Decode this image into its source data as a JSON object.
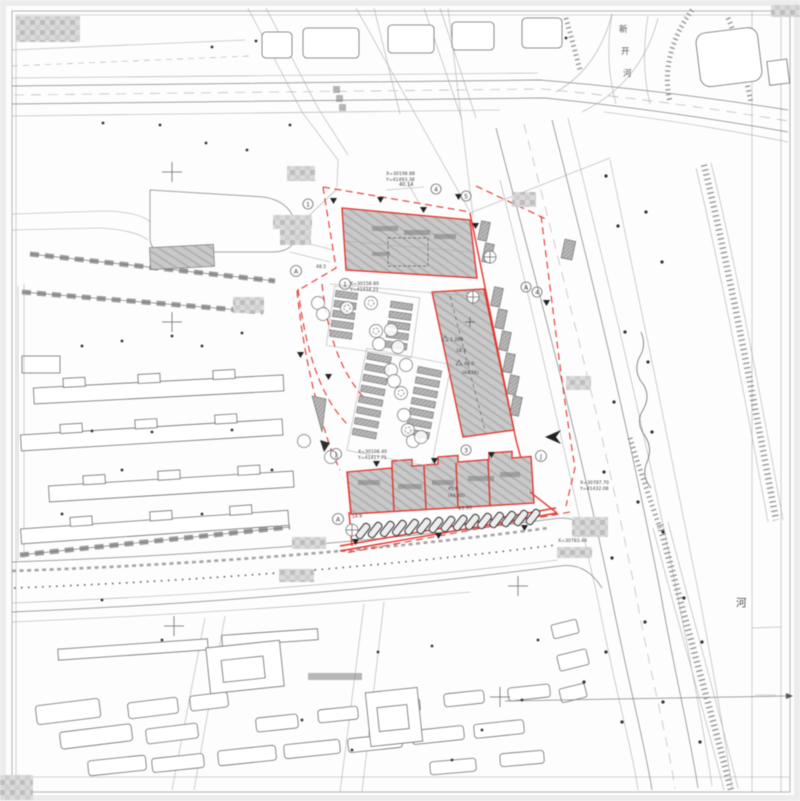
{
  "labels": {
    "river_name": [
      "新",
      "开",
      "河"
    ],
    "river_char": "河",
    "coord1x": "X=30198.88",
    "coord1y": "Y=41493.38",
    "coord2x": "X=30158.80",
    "coord2y": "Y=41434.21",
    "coord3x": "X=30108.40",
    "coord3y": "Y=41417.75",
    "coord4x": "X=30787.70",
    "coord4y": "Y=41432.08",
    "coord5x": "X=30783.44"
  },
  "dims": {
    "top": "40.14",
    "bottom": "43.90",
    "left": "14.9",
    "west": "48.5"
  },
  "elevations": {
    "e1": "1.289",
    "e2": "18.5",
    "e3": "46.0",
    "e4": "(44.56)",
    "e5": "45.6",
    "e6": "(44.80)"
  },
  "markers": {
    "a": "A",
    "j": "J",
    "n1": "1",
    "n3": "3",
    "n4": "4",
    "n5": "5"
  },
  "colors": {
    "boundary_red": "#e5322b",
    "building_gray": "#c9c9c9",
    "line_gray": "#858585"
  }
}
